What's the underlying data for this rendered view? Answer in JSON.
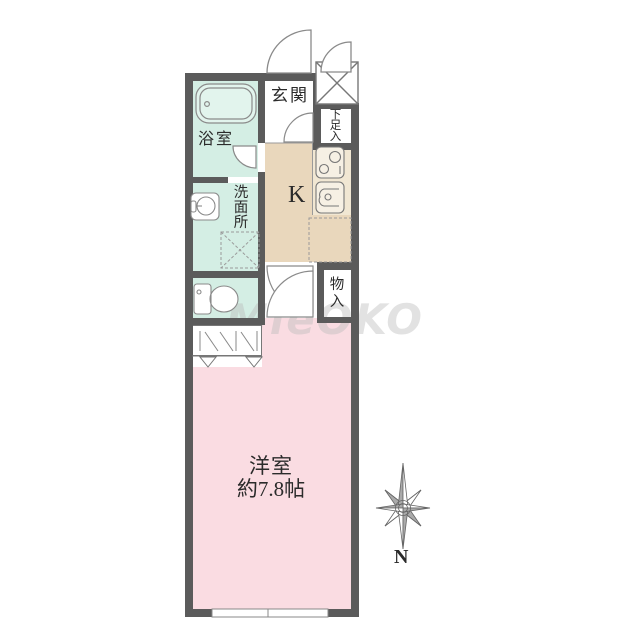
{
  "floor_plan": {
    "rooms": {
      "genkan": "玄関",
      "shoe_storage": "下足入",
      "bathroom": "浴室",
      "washroom": "洗面所",
      "kitchen": "K",
      "storage": "物入",
      "main_room_name": "洋室",
      "main_room_size": "約7.8帖"
    },
    "compass_label": "N",
    "watermark": "MieOKO",
    "colors": {
      "wall": "#5b5b5b",
      "wet_area": "#d4eee4",
      "kitchen_floor": "#e9d7bc",
      "main_room_floor": "#fadce2"
    }
  }
}
